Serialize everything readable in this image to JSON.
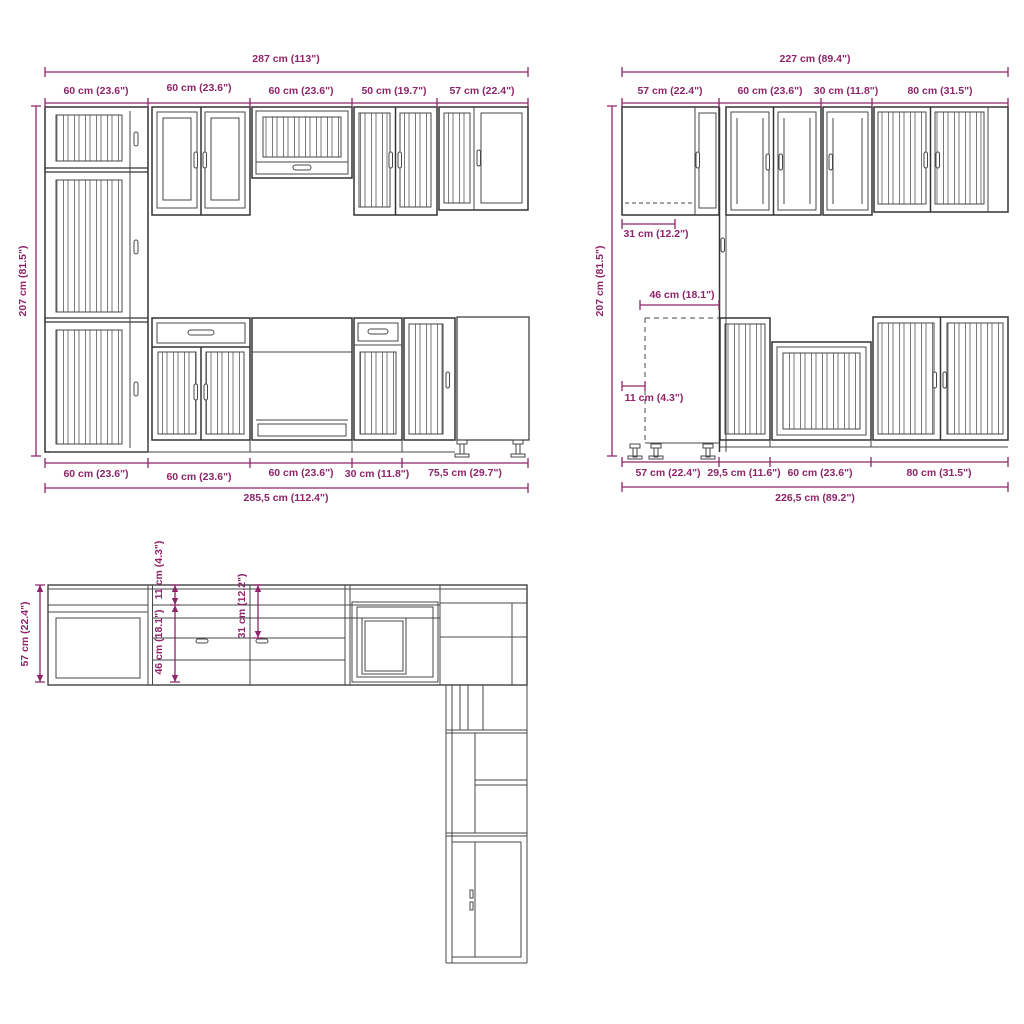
{
  "colors": {
    "dimension": "#8e2569",
    "line_art": "#474747"
  },
  "front_left": {
    "total_top": "287 cm (113\")",
    "top_segments": [
      "60 cm (23.6\")",
      "60 cm (23.6\")",
      "60 cm (23.6\")",
      "50 cm (19.7\")",
      "57 cm (22.4\")"
    ],
    "height": "207 cm (81.5\")",
    "bottom_segments": [
      "60 cm (23.6\")",
      "60 cm (23.6\")",
      "60 cm (23.6\")",
      "30 cm (11.8\")",
      "75,5 cm (29.7\")"
    ],
    "total_bottom": "285,5 cm (112.4\")"
  },
  "front_right": {
    "total_top": "227 cm (89.4\")",
    "top_segments": [
      "57 cm (22.4\")",
      "60 cm (23.6\")",
      "30 cm (11.8\")",
      "80 cm (31.5\")"
    ],
    "height": "207 cm (81.5\")",
    "corner_depth": "31 cm (12.2\")",
    "recess_width": "46 cm (18.1\")",
    "side_offset": "11 cm (4.3\")",
    "bottom_segments": [
      "57 cm (22.4\")",
      "29,5 cm (11.6\")",
      "60 cm (23.6\")",
      "80 cm (31.5\")"
    ],
    "total_bottom": "226,5 cm (89.2\")"
  },
  "plan": {
    "depth": "57 cm (22.4\")",
    "offset_11": "11 cm (4.3\")",
    "recess_46": "46 cm (18.1\")",
    "depth_31": "31 cm (12.2\")"
  }
}
